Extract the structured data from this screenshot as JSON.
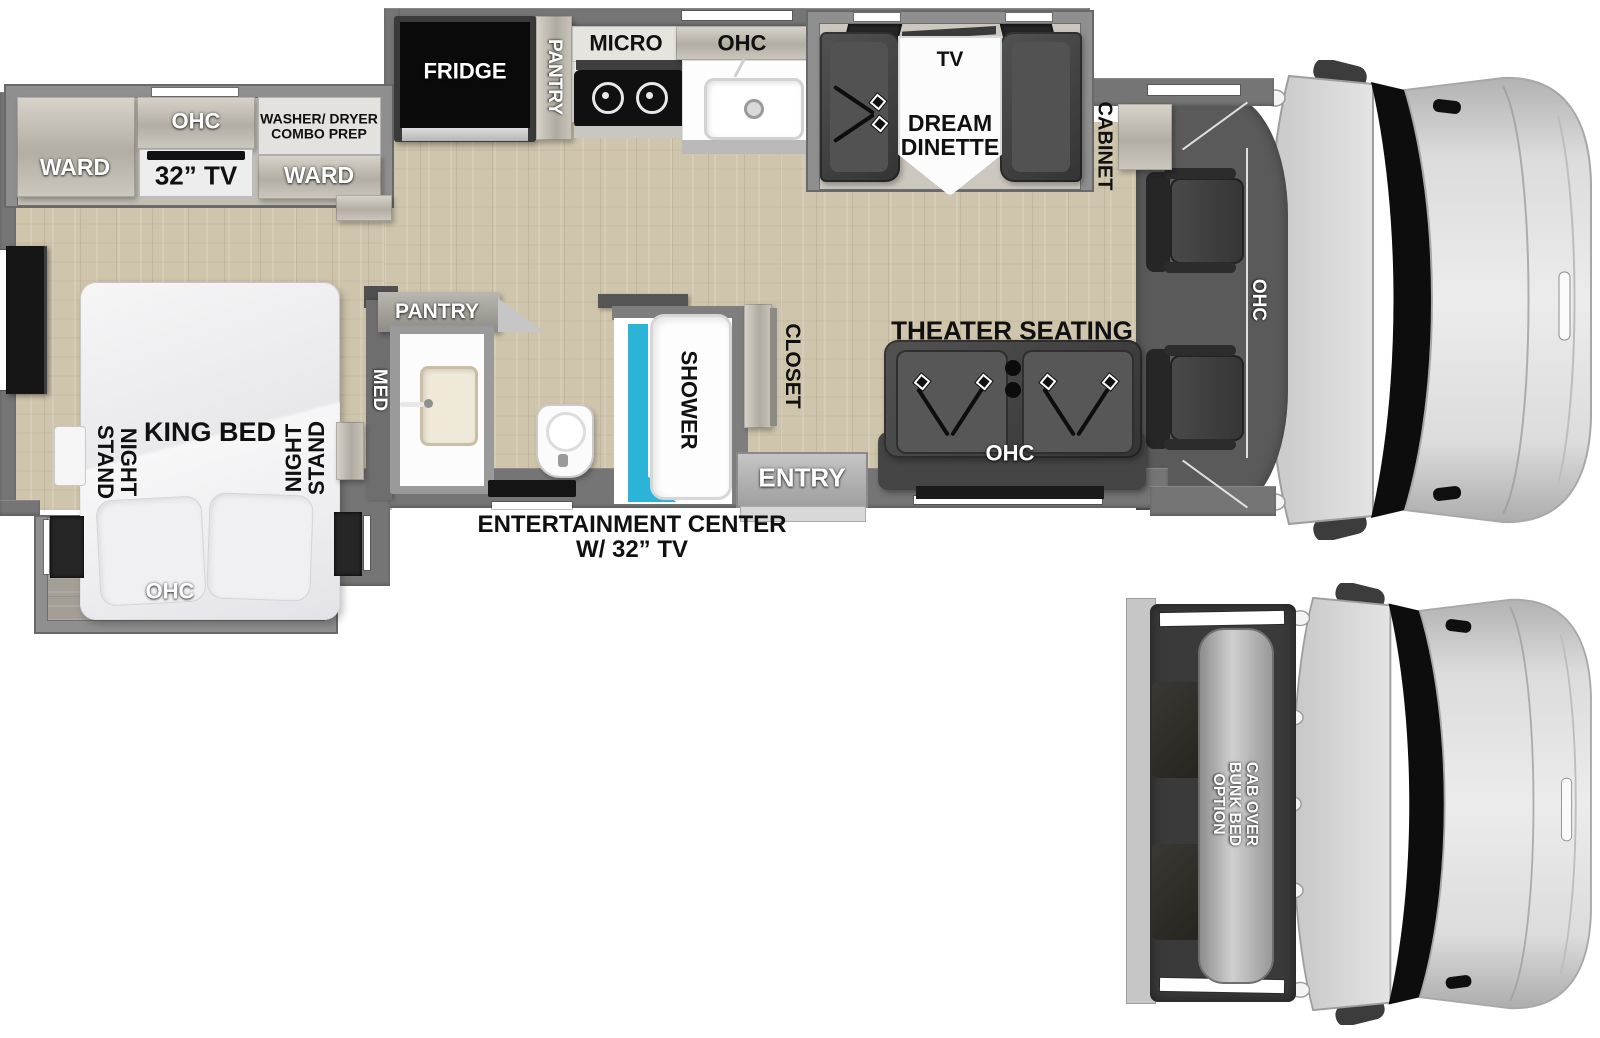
{
  "labels": {
    "bedroom": {
      "ward_left": "WARD",
      "ohc_top": "OHC",
      "tv_32": "32” TV",
      "washer_prep": "WASHER/ DRYER COMBO PREP",
      "ward_right": "WARD",
      "night_stand_left": "NIGHT STAND",
      "king_bed": "KING BED",
      "night_stand_right": "NIGHT STAND",
      "ohc_foot": "OHC"
    },
    "kitchen": {
      "fridge": "FRIDGE",
      "pantry": "PANTRY",
      "micro": "MICRO",
      "ohc": "OHC"
    },
    "dinette": {
      "tv": "TV",
      "name": "DREAM DINETTE"
    },
    "cab": {
      "cabinet": "CABINET",
      "ohc": "OHC"
    },
    "bath": {
      "pantry": "PANTRY",
      "med": "MED",
      "shower": "SHOWER"
    },
    "living": {
      "closet": "CLOSET",
      "theater": "THEATER SEATING",
      "theater_ohc": "OHC",
      "entry": "ENTRY"
    },
    "entertainment": {
      "line1": "ENTERTAINMENT CENTER",
      "line2": "W/ 32” TV"
    },
    "bunk": {
      "option": "CAB OVER BUNK BED OPTION"
    }
  },
  "colors": {
    "floor_wood": "#cfc5ac",
    "wall_gray": "#757575",
    "slide_border": "#8f8f8f",
    "furniture_dark": "#3f3f3f",
    "shower_accent": "#2bb3d8",
    "cab_body": "#d9d9d9",
    "label_black": "#101010",
    "label_white": "#ffffff"
  }
}
